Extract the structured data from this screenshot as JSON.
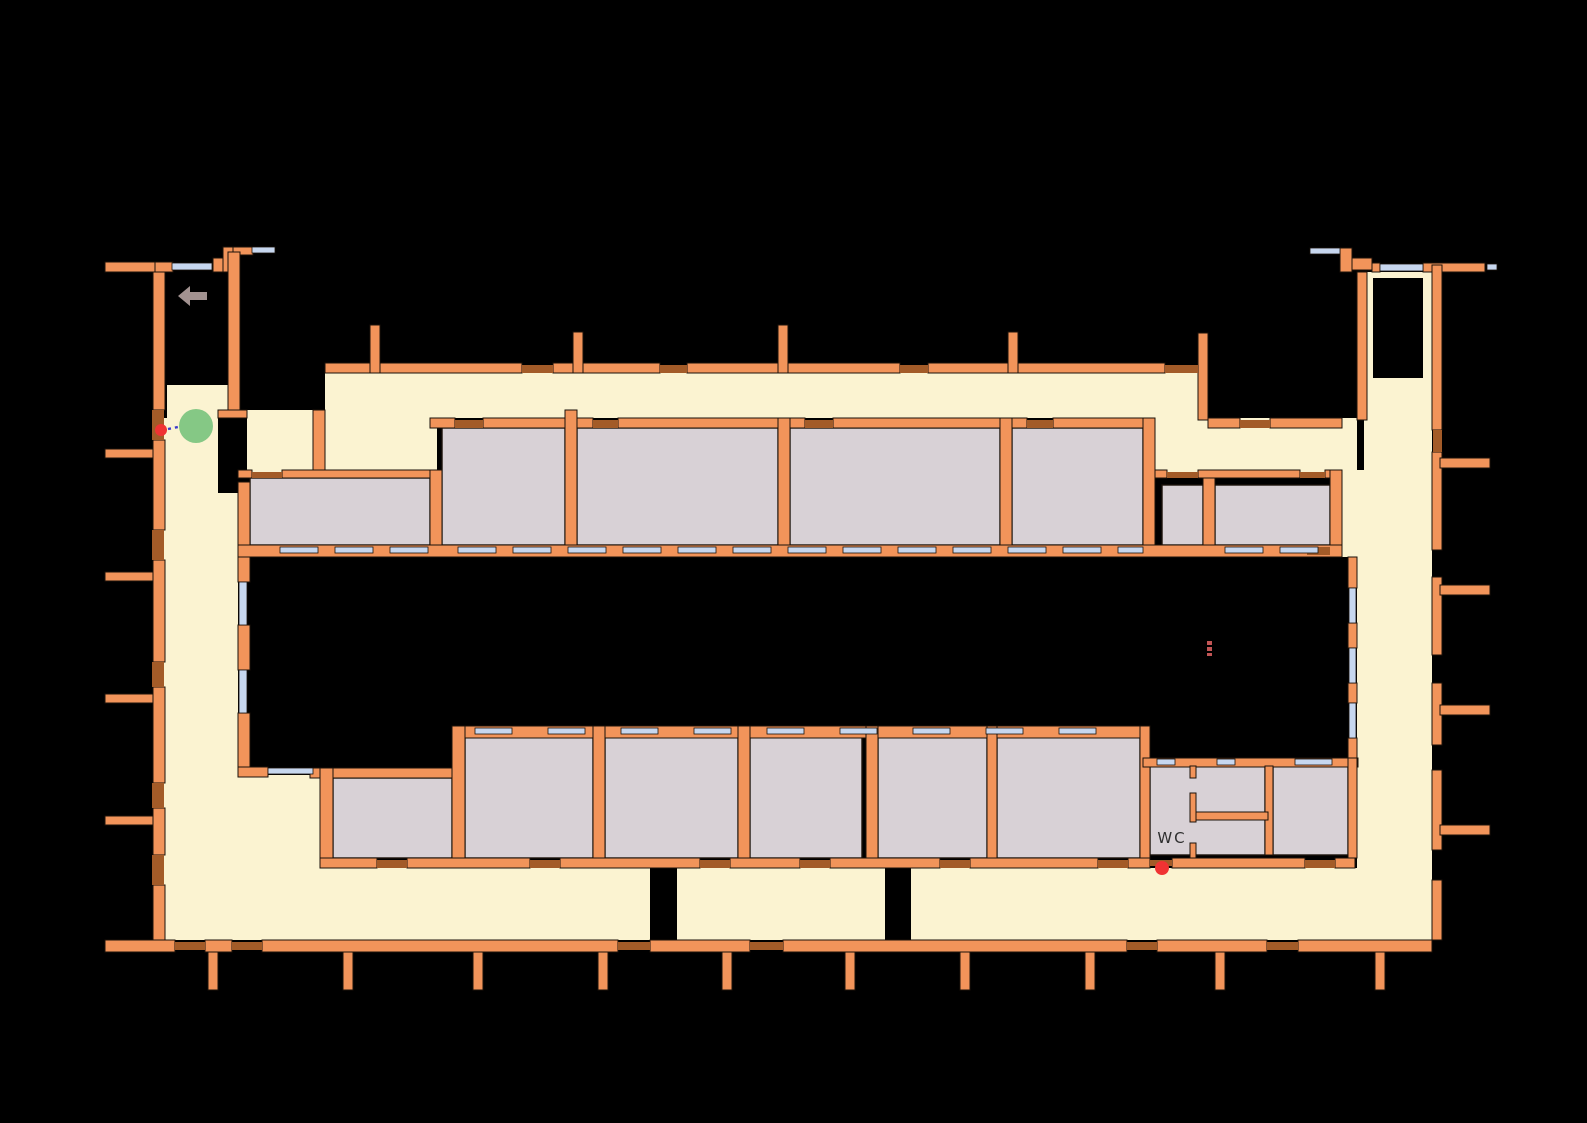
{
  "title": "building-floor-plan",
  "colors": {
    "background": "#000000",
    "wall": "#F2945A",
    "wall_outline": "#1b120a",
    "floor": "#FBF3D1",
    "room": "#D8D1D6",
    "door": "#A35B28",
    "window": "#C7D7EF",
    "agent": "#85C885",
    "waypoint": "#F03333",
    "path": "#3A3ACC",
    "arrow": "#A29290",
    "dash_mark": "#C25555",
    "label_text": "#2e2e2e"
  },
  "labels": [
    {
      "text": "WC",
      "x": 1172,
      "y": 843,
      "size": 15
    }
  ],
  "markers": {
    "agent": {
      "name": "agent-marker",
      "cx": 196,
      "cy": 426,
      "r": 17
    },
    "waypoints": [
      {
        "name": "waypoint-marker",
        "cx": 161,
        "cy": 430,
        "r": 6
      },
      {
        "name": "waypoint-marker",
        "cx": 1162,
        "cy": 868,
        "r": 7
      }
    ],
    "path": {
      "name": "path-line",
      "x1": 168,
      "y1": 429,
      "x2": 183,
      "y2": 426
    },
    "arrow": {
      "name": "direction-arrow-icon",
      "points": "178,296 190,286 190,292 207,292 207,300 190,300 190,306"
    },
    "dash_marks": [
      [
        1207,
        641,
        5,
        4
      ],
      [
        1207,
        647,
        5,
        4
      ],
      [
        1207,
        653,
        5,
        3
      ]
    ]
  },
  "floorplan": {
    "floors": [
      [
        167,
        385,
        61,
        33
      ],
      [
        153,
        418,
        65,
        75
      ],
      [
        153,
        493,
        85,
        447
      ],
      [
        238,
        868,
        1194,
        72
      ],
      [
        247,
        410,
        66,
        68
      ],
      [
        325,
        418,
        112,
        60
      ],
      [
        325,
        373,
        830,
        45
      ],
      [
        1155,
        373,
        43,
        105
      ],
      [
        1155,
        418,
        202,
        60
      ],
      [
        1364,
        272,
        68,
        206
      ],
      [
        1342,
        470,
        90,
        87
      ],
      [
        1357,
        557,
        75,
        311
      ],
      [
        238,
        775,
        82,
        93
      ]
    ],
    "patches": [
      [
        1373,
        278,
        50,
        100
      ],
      [
        650,
        868,
        27,
        75
      ],
      [
        885,
        868,
        26,
        75
      ]
    ],
    "rooms": [
      [
        250,
        478,
        180,
        67
      ],
      [
        442,
        428,
        123,
        117
      ],
      [
        577,
        428,
        201,
        117
      ],
      [
        790,
        428,
        210,
        117
      ],
      [
        1012,
        428,
        131,
        117
      ],
      [
        1162,
        485,
        41,
        60
      ],
      [
        1215,
        485,
        115,
        60
      ],
      [
        333,
        778,
        119,
        80
      ],
      [
        465,
        737,
        128,
        121
      ],
      [
        605,
        737,
        133,
        121
      ],
      [
        750,
        737,
        112,
        121
      ],
      [
        878,
        737,
        109,
        121
      ],
      [
        997,
        737,
        143,
        121
      ],
      [
        1150,
        766,
        115,
        89
      ],
      [
        1273,
        766,
        75,
        89
      ]
    ],
    "walls": [
      [
        105,
        262,
        50,
        10
      ],
      [
        155,
        262,
        18,
        10
      ],
      [
        213,
        258,
        20,
        14
      ],
      [
        223,
        247,
        10,
        25
      ],
      [
        233,
        247,
        20,
        8
      ],
      [
        153,
        272,
        12,
        138
      ],
      [
        153,
        440,
        12,
        90
      ],
      [
        153,
        560,
        12,
        102
      ],
      [
        153,
        687,
        12,
        96
      ],
      [
        153,
        808,
        12,
        47
      ],
      [
        153,
        885,
        12,
        55
      ],
      [
        228,
        252,
        12,
        163
      ],
      [
        218,
        410,
        29,
        8
      ],
      [
        313,
        410,
        12,
        68
      ],
      [
        105,
        449,
        48,
        9
      ],
      [
        105,
        572,
        48,
        9
      ],
      [
        105,
        694,
        48,
        9
      ],
      [
        105,
        816,
        48,
        9
      ],
      [
        105,
        940,
        70,
        12
      ],
      [
        205,
        940,
        27,
        12
      ],
      [
        262,
        940,
        356,
        12
      ],
      [
        650,
        940,
        100,
        12
      ],
      [
        783,
        940,
        344,
        12
      ],
      [
        1157,
        940,
        110,
        12
      ],
      [
        1298,
        940,
        134,
        12
      ],
      [
        208,
        952,
        10,
        38
      ],
      [
        343,
        952,
        10,
        38
      ],
      [
        473,
        952,
        10,
        38
      ],
      [
        598,
        952,
        10,
        38
      ],
      [
        722,
        952,
        10,
        38
      ],
      [
        845,
        952,
        10,
        38
      ],
      [
        960,
        952,
        10,
        38
      ],
      [
        1085,
        952,
        10,
        38
      ],
      [
        1215,
        952,
        10,
        38
      ],
      [
        1375,
        952,
        10,
        38
      ],
      [
        325,
        363,
        197,
        10
      ],
      [
        553,
        363,
        107,
        10
      ],
      [
        687,
        363,
        213,
        10
      ],
      [
        928,
        363,
        237,
        10
      ],
      [
        370,
        325,
        10,
        48
      ],
      [
        573,
        332,
        10,
        41
      ],
      [
        778,
        325,
        10,
        48
      ],
      [
        1008,
        332,
        10,
        41
      ],
      [
        1198,
        333,
        10,
        87
      ],
      [
        430,
        418,
        25,
        10
      ],
      [
        483,
        418,
        110,
        10
      ],
      [
        618,
        418,
        187,
        10
      ],
      [
        833,
        418,
        194,
        10
      ],
      [
        1053,
        418,
        102,
        10
      ],
      [
        238,
        470,
        14,
        8
      ],
      [
        282,
        470,
        160,
        8
      ],
      [
        1155,
        470,
        12,
        8
      ],
      [
        1198,
        470,
        102,
        8
      ],
      [
        1325,
        470,
        17,
        8
      ],
      [
        1208,
        418,
        32,
        10
      ],
      [
        1270,
        418,
        72,
        10
      ],
      [
        238,
        482,
        12,
        75
      ],
      [
        430,
        470,
        12,
        87
      ],
      [
        565,
        410,
        12,
        147
      ],
      [
        778,
        418,
        12,
        139
      ],
      [
        1000,
        418,
        12,
        139
      ],
      [
        1143,
        418,
        12,
        139
      ],
      [
        1203,
        478,
        12,
        79
      ],
      [
        1330,
        470,
        12,
        87
      ],
      [
        238,
        545,
        1104,
        12
      ],
      [
        238,
        557,
        12,
        25
      ],
      [
        238,
        625,
        12,
        45
      ],
      [
        238,
        713,
        12,
        54
      ],
      [
        238,
        767,
        30,
        10
      ],
      [
        310,
        768,
        155,
        10
      ],
      [
        452,
        726,
        696,
        12
      ],
      [
        320,
        768,
        13,
        100
      ],
      [
        452,
        726,
        13,
        142
      ],
      [
        593,
        726,
        12,
        142
      ],
      [
        738,
        726,
        12,
        142
      ],
      [
        866,
        726,
        12,
        142
      ],
      [
        987,
        726,
        10,
        142
      ],
      [
        1140,
        726,
        10,
        134
      ],
      [
        320,
        858,
        57,
        10
      ],
      [
        407,
        858,
        123,
        10
      ],
      [
        560,
        858,
        140,
        10
      ],
      [
        730,
        858,
        70,
        10
      ],
      [
        830,
        858,
        110,
        10
      ],
      [
        970,
        858,
        128,
        10
      ],
      [
        1128,
        858,
        22,
        10
      ],
      [
        1172,
        858,
        133,
        10
      ],
      [
        1335,
        858,
        20,
        10
      ],
      [
        1143,
        758,
        215,
        9
      ],
      [
        1265,
        766,
        8,
        89
      ],
      [
        1190,
        766,
        6,
        12
      ],
      [
        1190,
        793,
        6,
        29
      ],
      [
        1190,
        843,
        6,
        15
      ],
      [
        1196,
        812,
        72,
        8
      ],
      [
        1348,
        557,
        9,
        31
      ],
      [
        1348,
        623,
        9,
        25
      ],
      [
        1348,
        683,
        9,
        20
      ],
      [
        1348,
        738,
        9,
        20
      ],
      [
        1348,
        758,
        9,
        100
      ],
      [
        1340,
        248,
        12,
        24
      ],
      [
        1352,
        258,
        20,
        12
      ],
      [
        1372,
        263,
        8,
        9
      ],
      [
        1423,
        263,
        62,
        9
      ],
      [
        1357,
        272,
        10,
        148
      ],
      [
        1432,
        265,
        10,
        165
      ],
      [
        1432,
        452,
        10,
        98
      ],
      [
        1432,
        577,
        10,
        78
      ],
      [
        1432,
        683,
        10,
        62
      ],
      [
        1432,
        770,
        10,
        80
      ],
      [
        1432,
        880,
        10,
        60
      ],
      [
        1440,
        458,
        50,
        10
      ],
      [
        1440,
        585,
        50,
        10
      ],
      [
        1440,
        705,
        50,
        10
      ],
      [
        1440,
        825,
        50,
        10
      ]
    ],
    "doors": [
      [
        152,
        410,
        12,
        30
      ],
      [
        152,
        530,
        12,
        30
      ],
      [
        152,
        662,
        12,
        25
      ],
      [
        152,
        783,
        12,
        25
      ],
      [
        152,
        855,
        12,
        30
      ],
      [
        175,
        942,
        30,
        8
      ],
      [
        232,
        942,
        30,
        8
      ],
      [
        618,
        942,
        32,
        8
      ],
      [
        750,
        942,
        33,
        8
      ],
      [
        1127,
        942,
        30,
        8
      ],
      [
        1267,
        942,
        31,
        8
      ],
      [
        522,
        365,
        31,
        8
      ],
      [
        660,
        365,
        27,
        8
      ],
      [
        900,
        365,
        28,
        8
      ],
      [
        1165,
        365,
        33,
        8
      ],
      [
        455,
        420,
        28,
        8
      ],
      [
        593,
        420,
        25,
        8
      ],
      [
        805,
        420,
        28,
        8
      ],
      [
        1027,
        420,
        26,
        8
      ],
      [
        252,
        472,
        30,
        6
      ],
      [
        1167,
        472,
        31,
        6
      ],
      [
        1300,
        472,
        25,
        6
      ],
      [
        1240,
        420,
        30,
        8
      ],
      [
        377,
        860,
        30,
        8
      ],
      [
        530,
        860,
        30,
        8
      ],
      [
        700,
        860,
        30,
        8
      ],
      [
        800,
        860,
        30,
        8
      ],
      [
        940,
        860,
        30,
        8
      ],
      [
        1098,
        860,
        30,
        8
      ],
      [
        1150,
        860,
        22,
        6
      ],
      [
        1305,
        860,
        30,
        8
      ],
      [
        1433,
        430,
        9,
        22
      ],
      [
        1307,
        547,
        23,
        8
      ]
    ],
    "windows": [
      [
        172,
        263,
        40,
        7
      ],
      [
        252,
        247,
        23,
        6
      ],
      [
        1310,
        248,
        30,
        6
      ],
      [
        1380,
        264,
        43,
        7
      ],
      [
        1487,
        264,
        10,
        6
      ],
      [
        280,
        547,
        38,
        6
      ],
      [
        335,
        547,
        38,
        6
      ],
      [
        390,
        547,
        38,
        6
      ],
      [
        458,
        547,
        38,
        6
      ],
      [
        513,
        547,
        38,
        6
      ],
      [
        568,
        547,
        38,
        6
      ],
      [
        623,
        547,
        38,
        6
      ],
      [
        678,
        547,
        38,
        6
      ],
      [
        733,
        547,
        38,
        6
      ],
      [
        788,
        547,
        38,
        6
      ],
      [
        843,
        547,
        38,
        6
      ],
      [
        898,
        547,
        38,
        6
      ],
      [
        953,
        547,
        38,
        6
      ],
      [
        1008,
        547,
        38,
        6
      ],
      [
        1063,
        547,
        38,
        6
      ],
      [
        1118,
        547,
        25,
        6
      ],
      [
        1225,
        547,
        38,
        6
      ],
      [
        1280,
        547,
        38,
        6
      ],
      [
        239,
        582,
        8,
        43
      ],
      [
        239,
        670,
        8,
        43
      ],
      [
        1349,
        588,
        7,
        35
      ],
      [
        1349,
        648,
        7,
        35
      ],
      [
        1349,
        703,
        7,
        35
      ],
      [
        475,
        728,
        37,
        6
      ],
      [
        548,
        728,
        37,
        6
      ],
      [
        621,
        728,
        37,
        6
      ],
      [
        694,
        728,
        37,
        6
      ],
      [
        767,
        728,
        37,
        6
      ],
      [
        840,
        728,
        37,
        6
      ],
      [
        913,
        728,
        37,
        6
      ],
      [
        986,
        728,
        37,
        6
      ],
      [
        1059,
        728,
        37,
        6
      ],
      [
        268,
        768,
        45,
        6
      ],
      [
        1157,
        759,
        18,
        6
      ],
      [
        1217,
        759,
        18,
        6
      ],
      [
        1295,
        759,
        37,
        6
      ]
    ]
  }
}
